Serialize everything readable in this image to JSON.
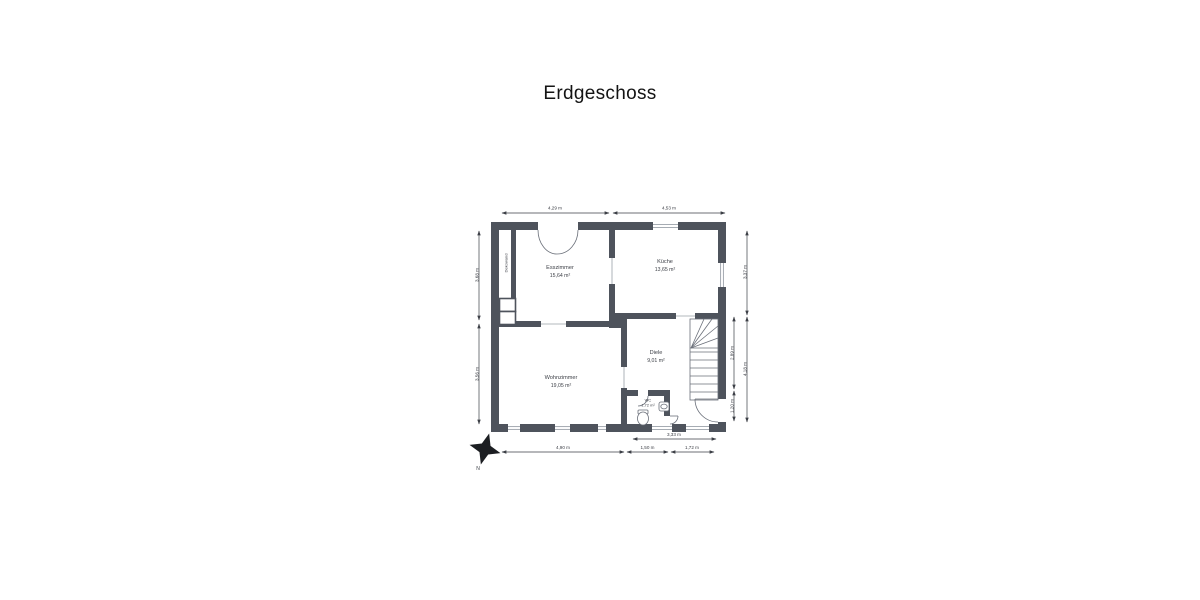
{
  "page": {
    "title": "Erdgeschoss"
  },
  "colors": {
    "wall": "#4e535c",
    "line": "#6a6f79",
    "dim": "#3c3f46"
  },
  "rooms": [
    {
      "name": "Esszimmer",
      "area": "15,64 m²"
    },
    {
      "name": "Küche",
      "area": "13,65 m²"
    },
    {
      "name": "Wohnzimmer",
      "area": "19,05 m²"
    },
    {
      "name": "Diele",
      "area": "9,01 m²"
    },
    {
      "name": "WC",
      "area": "1,72 m²"
    }
  ],
  "annotations": {
    "dekowand": "Dekowand",
    "compass_north": "N"
  },
  "dimensions": {
    "top": [
      "4,29 m",
      "4,53 m"
    ],
    "left": [
      "3,68 m",
      "3,56 m"
    ],
    "right_outer": [
      "3,37 m",
      "4,18 m"
    ],
    "right_inner": [
      "2,89 m",
      "1,20 m"
    ],
    "bottom_upper": [
      "3,33 m"
    ],
    "bottom_lower": [
      "4,90 m",
      "1,50 m",
      "1,72 m"
    ]
  }
}
